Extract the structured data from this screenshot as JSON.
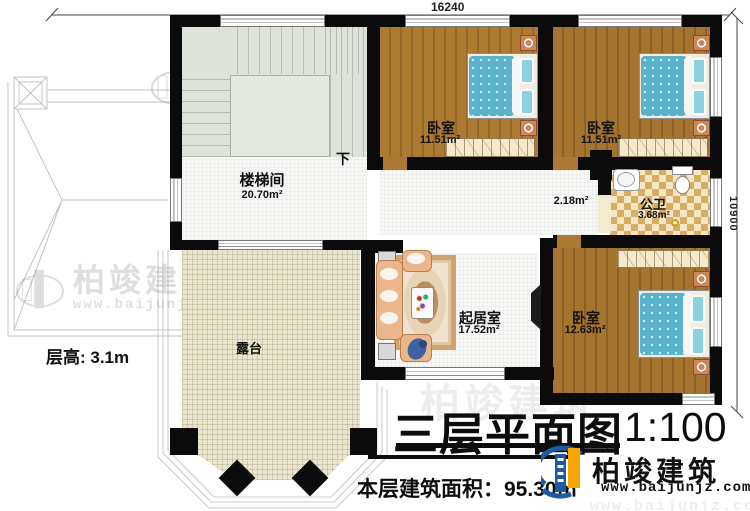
{
  "dimensions": {
    "top_width": "16240",
    "right_height": "10900"
  },
  "floor_height_note": "层高: 3.1m",
  "stair": {
    "direction_label": "下"
  },
  "rooms": {
    "stairwell": {
      "name": "楼梯间",
      "area": "20.70m²"
    },
    "bedroom1": {
      "name": "卧室",
      "area": "11.51m²"
    },
    "bedroom2": {
      "name": "卧室",
      "area": "11.51m²"
    },
    "bedroom3": {
      "name": "卧室",
      "area": "12.63m²"
    },
    "bathroom": {
      "name": "公卫",
      "area": "3.68m²"
    },
    "living": {
      "name": "起居室",
      "area": "17.52m²"
    },
    "terrace": {
      "name": "露台"
    },
    "hall": {
      "area": "2.18m²"
    }
  },
  "title_block": {
    "title": "三层平面图",
    "scale": "1:100",
    "floor_area_line": "本层建筑面积：95.30㎡"
  },
  "logo": {
    "name": "柏竣建筑",
    "url": "www.baijunjz.com"
  },
  "watermark": {
    "text": "柏竣建筑",
    "url": "www.baijunjz.com"
  },
  "colors": {
    "wall": "#0b0b0b",
    "wood_floor": "#ab7931",
    "bed": "#58b2cc",
    "bath_tile": "#d8ac61",
    "terrace_floor": "#eae5cf",
    "stairs": "#dde3d9",
    "logo_blue": "#1d5ba5",
    "logo_orange": "#f7a600"
  }
}
